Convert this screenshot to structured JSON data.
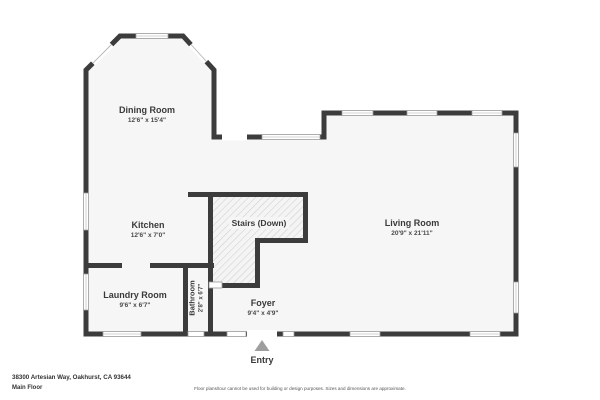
{
  "plan": {
    "rooms": {
      "dining": {
        "name": "Dining Room",
        "dims": "12'6\" x 15'4\""
      },
      "kitchen": {
        "name": "Kitchen",
        "dims": "12'6\" x 7'0\""
      },
      "laundry": {
        "name": "Laundry Room",
        "dims": "9'6\" x 6'7\""
      },
      "bathroom": {
        "name": "Bathroom",
        "dims": "2'8\" x 6'7\""
      },
      "stairs": {
        "name": "Stairs (Down)"
      },
      "foyer": {
        "name": "Foyer",
        "dims": "9'4\" x 4'9\""
      },
      "living": {
        "name": "Living Room",
        "dims": "20'9\" x 21'11\""
      }
    },
    "entry_label": "Entry"
  },
  "footer": {
    "address": "38300 Artesian Way, Oakhurst, CA 93644",
    "floor": "Main Floor",
    "disclaimer": "Floor plans/tour cannot be used for building or design purposes. Sizes and dimensions are approximate."
  },
  "colors": {
    "wall": "#3c3c3c",
    "floor": "#f6f6f6",
    "entry_arrow": "#9e9e9e"
  }
}
